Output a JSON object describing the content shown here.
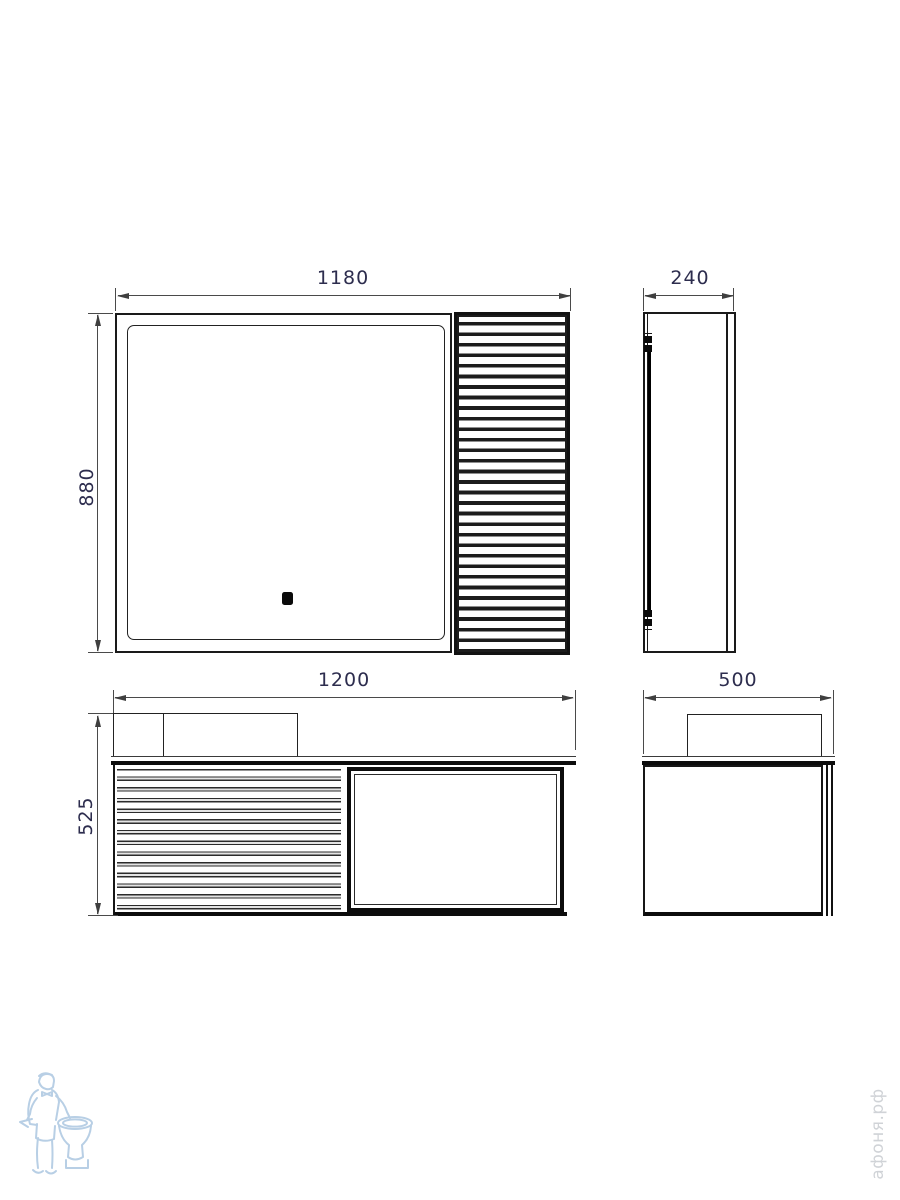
{
  "views": {
    "mirror_front": {
      "width_mm": "1180",
      "height_mm": "880"
    },
    "mirror_side": {
      "depth_mm": "240"
    },
    "vanity_front": {
      "width_mm": "1200",
      "height_mm": "525"
    },
    "vanity_side": {
      "depth_mm": "500"
    }
  },
  "watermark": {
    "site": "афоня.рф"
  },
  "colors": {
    "line": "#1a1a1a",
    "dimension_line": "#4a4a4a",
    "dimension_text": "#2d2d4e",
    "logo_blue": "#b8cfe5",
    "watermark_text": "#d0d3d7"
  }
}
